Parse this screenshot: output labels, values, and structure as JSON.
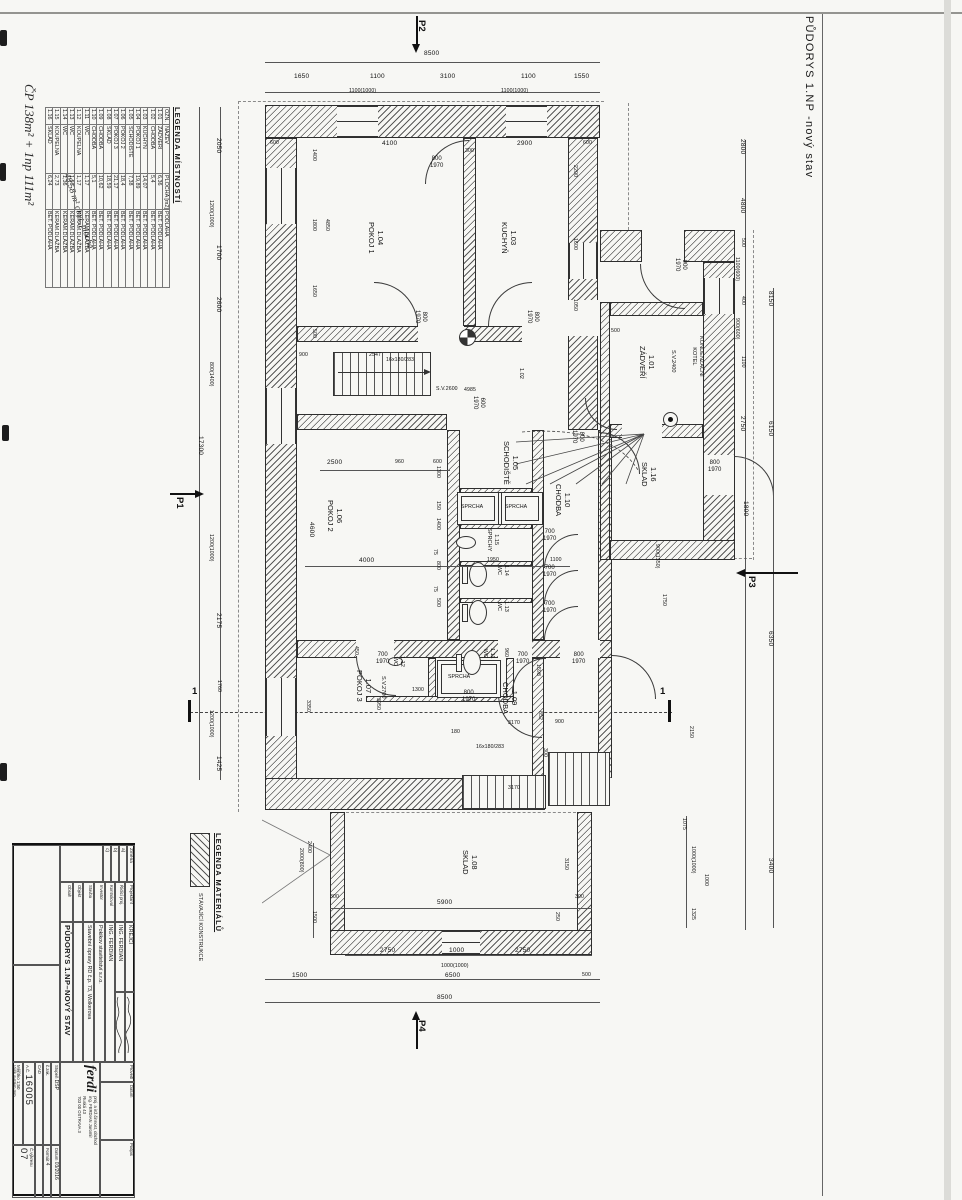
{
  "sheet": {
    "title": "PŮDORYS 1.NP  -nový stav",
    "handwriting_top": "ČP 138m² + 1np 111m²",
    "handwriting_table": "48,58 m² obyt. plocha"
  },
  "legend_rooms": {
    "title": "LEGENDA MÍSTNOSTÍ",
    "headers": [
      "OZN.",
      "NÁZEV",
      "PLOCHA [m2]",
      "PODLAHA"
    ],
    "rows": [
      [
        "1.01",
        "ZÁDVEŘÍ",
        "6,36",
        "BET. PODLAHA"
      ],
      [
        "1.02",
        "CHODBA",
        "5,4",
        "BET. PODLAHA"
      ],
      [
        "1.03",
        "KUCHYŇ",
        "14,07",
        "BET. PODLAHA"
      ],
      [
        "1.04",
        "POKOJ 1",
        "19,89",
        "BET. PODLAHA"
      ],
      [
        "1.05",
        "SCHODIŠTĚ",
        "7,38",
        "BET. PODLAHA"
      ],
      [
        "1.06",
        "POKOJ 2",
        "18,4",
        "BET. PODLAHA"
      ],
      [
        "1.07",
        "POKOJ 3",
        "21,17",
        "BET. PODLAHA"
      ],
      [
        "1.08",
        "SKLAD",
        "18,59",
        "BET. PODLAHA"
      ],
      [
        "1.09",
        "CHODBA",
        "10,62",
        "BET. PODLAHA"
      ],
      [
        "1.10",
        "CHODBA",
        "5,1",
        "BET. PODLAHA"
      ],
      [
        "1.11",
        "WC",
        "1,17",
        "KERAM.DLAŽBA"
      ],
      [
        "1.12",
        "KOUPELNA",
        "1,17",
        "KERAM.DLAŽBA"
      ],
      [
        "1.13",
        "WC",
        "1,56",
        "KERAM.DLAŽBA"
      ],
      [
        "1.14",
        "WC",
        "1,36",
        "KERAM.DLAŽBA"
      ],
      [
        "1.15",
        "KOUPELNA",
        "2,73",
        "KERAM.DLAŽBA"
      ],
      [
        "1.16",
        "SKLAD",
        "6,24",
        "BET. PODLAHA"
      ]
    ]
  },
  "legend_materials": {
    "title": "LEGENDA  MATERIÁLŮ",
    "item1": "STÁVAJÍCÍ KONSTRUKCE"
  },
  "titleblock": {
    "zmena_label": "Změna",
    "zmena_a": "a)",
    "zmena_b": "b)",
    "zmena_c": "c)",
    "projektant_label": "Projektant",
    "projektant_value": "KREJČÍ",
    "ridici_label": "Řídící proj.",
    "ridici_value": "ING. FERDIAN",
    "kontroloval_label": "Kontroloval",
    "kontroloval_value": "ING. FERDIAN",
    "investor_label": "Investor",
    "investor_value": "Pokikov stavitelství s.r.o.",
    "stavba_label": "Stavba",
    "stavba_value": "Stavební úpravy RD č.p. 73, Wolkerova",
    "objekt_label": "Objekt",
    "obsah_label": "Obsah",
    "obsah_value": "PŮDORYS 1.NP–NOVÝ STAV",
    "provedl_label": "Provedl",
    "datum_label": "Datum",
    "podpis_label": "Podpis",
    "firm_logo": "ferdi",
    "firm_line1": "proj. a inž.činnost, obchod",
    "firm_line2": "ing. FERDIAN Jaromír",
    "firm_line3": "Ruská 43",
    "firm_line4": "703 00 OSTRAVA 3",
    "stupen_label": "Stupeň",
    "stupen_value": "DSP",
    "datum2_label": "Datum",
    "datum2_value": "03/2016",
    "zakazka_label": "č.zak.",
    "format_label": "Formát",
    "format_value": "4",
    "cad_label": "CAD",
    "ac_label": "A.Č.",
    "ac_value": "16005",
    "meritko_label": "Měřítko",
    "meritko_value": "1:50",
    "vysky_label": "Výšk.systém",
    "vysky_value": "mm",
    "cvykresu_label": "Č.výkresu",
    "cvykresu_value": "07"
  },
  "plan": {
    "labels": [
      {
        "t": "1.04\nPOKOJ 1",
        "x": 370,
        "y": 222,
        "r": 1,
        "c": "room",
        "n": "room-label-1-04"
      },
      {
        "t": "1.03\nKUCHYŇ",
        "x": 503,
        "y": 222,
        "r": 1,
        "c": "room",
        "n": "room-label-1-03"
      },
      {
        "t": "1.01\nZÁDVEŘÍ",
        "x": 641,
        "y": 346,
        "r": 1,
        "c": "room",
        "n": "room-label-1-01"
      },
      {
        "t": "1.05\nSCHODIŠTĚ",
        "x": 505,
        "y": 441,
        "r": 1,
        "c": "room",
        "n": "room-label-1-05"
      },
      {
        "t": "1.10\nCHODBA",
        "x": 557,
        "y": 484,
        "r": 1,
        "c": "room",
        "n": "room-label-1-10"
      },
      {
        "t": "1.06\nPOKOJ 2",
        "x": 329,
        "y": 500,
        "r": 1,
        "c": "room",
        "n": "room-label-1-06"
      },
      {
        "t": "1.16\nSKLAD",
        "x": 643,
        "y": 462,
        "r": 1,
        "c": "room",
        "n": "room-label-1-16"
      },
      {
        "t": "1.07\nPOKOJ 3",
        "x": 358,
        "y": 670,
        "r": 1,
        "c": "room",
        "n": "room-label-1-07"
      },
      {
        "t": "1.09\nCHODBA",
        "x": 504,
        "y": 682,
        "r": 1,
        "c": "room",
        "n": "room-label-1-09"
      },
      {
        "t": "1.08\nSKLAD",
        "x": 464,
        "y": 850,
        "r": 1,
        "c": "room",
        "n": "room-label-1-08"
      },
      {
        "t": "1.15\nSPRCHY",
        "x": 484,
        "y": 528,
        "r": 1,
        "c": "roomt",
        "n": "room-label-1-15"
      },
      {
        "t": "1.14\nWC",
        "x": 494,
        "y": 565,
        "r": 1,
        "c": "roomt",
        "n": "room-label-1-14"
      },
      {
        "t": "1.13\nWC",
        "x": 494,
        "y": 601,
        "r": 1,
        "c": "roomt",
        "n": "room-label-1-13"
      },
      {
        "t": "1.12\nWC",
        "x": 390,
        "y": 656,
        "r": 1,
        "c": "roomt",
        "n": "room-label-1-12"
      },
      {
        "t": "1.11\nWC",
        "x": 480,
        "y": 648,
        "r": 1,
        "c": "roomt",
        "n": "room-label-1-11"
      },
      {
        "t": "1.02",
        "x": 516,
        "y": 368,
        "r": 1,
        "c": "roomt",
        "n": "room-label-1-02"
      },
      {
        "t": "S.V.2400",
        "x": 668,
        "y": 350,
        "r": 1,
        "c": "roomt",
        "n": "ceiling-height-label"
      },
      {
        "t": "S.V.2700",
        "x": 378,
        "y": 676,
        "r": 1,
        "c": "roomt",
        "n": "ceiling-height-label"
      },
      {
        "t": "S.V.2600",
        "x": 436,
        "y": 386,
        "r": 0,
        "c": "t",
        "n": "ceiling-height-label"
      },
      {
        "t": "KONDENZAČNÍ\nKOTEL",
        "x": 689,
        "y": 336,
        "r": 1,
        "c": "roomt",
        "n": "boiler-label"
      },
      {
        "t": "SPRCHA",
        "x": 461,
        "y": 504,
        "r": 0,
        "c": "t",
        "n": "shower-label"
      },
      {
        "t": "SPRCHA",
        "x": 505,
        "y": 504,
        "r": 0,
        "c": "t",
        "n": "shower-label"
      },
      {
        "t": "SPRCHA",
        "x": 448,
        "y": 674,
        "r": 0,
        "c": "t",
        "n": "shower-label"
      },
      {
        "t": "16x180/283",
        "x": 386,
        "y": 357,
        "r": 0,
        "c": "t",
        "n": "stair-label"
      },
      {
        "t": "16x180/283",
        "x": 476,
        "y": 744,
        "r": 0,
        "c": "t",
        "n": "stair-label"
      },
      {
        "t": "800\n1970",
        "x": 430,
        "y": 156,
        "r": 0,
        "c": "door",
        "n": "door-size-label"
      },
      {
        "t": "800\n1970",
        "x": 412,
        "y": 310,
        "r": 1,
        "c": "door",
        "n": "door-size-label"
      },
      {
        "t": "800\n1970",
        "x": 524,
        "y": 310,
        "r": 1,
        "c": "door",
        "n": "door-size-label"
      },
      {
        "t": "900\n1970",
        "x": 672,
        "y": 258,
        "r": 1,
        "c": "door",
        "n": "door-size-label"
      },
      {
        "t": "800\n1970",
        "x": 569,
        "y": 430,
        "r": 1,
        "c": "door",
        "n": "door-size-label"
      },
      {
        "t": "600\n1970",
        "x": 470,
        "y": 396,
        "r": 1,
        "c": "door",
        "n": "door-size-label"
      },
      {
        "t": "700\n1970",
        "x": 543,
        "y": 529,
        "r": 0,
        "c": "door",
        "n": "door-size-label"
      },
      {
        "t": "700\n1970",
        "x": 543,
        "y": 565,
        "r": 0,
        "c": "door",
        "n": "door-size-label"
      },
      {
        "t": "700\n1970",
        "x": 543,
        "y": 601,
        "r": 0,
        "c": "door",
        "n": "door-size-label"
      },
      {
        "t": "700\n1970",
        "x": 376,
        "y": 652,
        "r": 0,
        "c": "door",
        "n": "door-size-label"
      },
      {
        "t": "700\n1970",
        "x": 516,
        "y": 652,
        "r": 0,
        "c": "door",
        "n": "door-size-label"
      },
      {
        "t": "800\n1970",
        "x": 572,
        "y": 652,
        "r": 0,
        "c": "door",
        "n": "door-size-label"
      },
      {
        "t": "800\n1970",
        "x": 462,
        "y": 690,
        "r": 0,
        "c": "door",
        "n": "door-size-label"
      },
      {
        "t": "800\n1970",
        "x": 708,
        "y": 460,
        "r": 0,
        "c": "door",
        "n": "door-size-label"
      },
      {
        "t": "8500",
        "x": 424,
        "y": 50
      },
      {
        "t": "1650",
        "x": 294,
        "y": 73
      },
      {
        "t": "1100",
        "x": 370,
        "y": 73
      },
      {
        "t": "3100",
        "x": 440,
        "y": 73
      },
      {
        "t": "1100",
        "x": 521,
        "y": 73
      },
      {
        "t": "1550",
        "x": 574,
        "y": 73
      },
      {
        "t": "1100(1000)",
        "x": 349,
        "y": 88,
        "c": "t"
      },
      {
        "t": "1100(1000)",
        "x": 501,
        "y": 88,
        "c": "t"
      },
      {
        "t": "600",
        "x": 270,
        "y": 140,
        "c": "t"
      },
      {
        "t": "4100",
        "x": 382,
        "y": 140
      },
      {
        "t": "300",
        "x": 465,
        "y": 148,
        "c": "t"
      },
      {
        "t": "2900",
        "x": 517,
        "y": 140
      },
      {
        "t": "600",
        "x": 583,
        "y": 140,
        "c": "t"
      },
      {
        "t": "900",
        "x": 299,
        "y": 352,
        "c": "t"
      },
      {
        "t": "2547",
        "x": 369,
        "y": 352,
        "c": "t"
      },
      {
        "t": "4985",
        "x": 464,
        "y": 387,
        "c": "t"
      },
      {
        "t": "500",
        "x": 611,
        "y": 328,
        "c": "t"
      },
      {
        "t": "2500",
        "x": 327,
        "y": 459
      },
      {
        "t": "960",
        "x": 395,
        "y": 459,
        "c": "t"
      },
      {
        "t": "600",
        "x": 433,
        "y": 459,
        "c": "t"
      },
      {
        "t": "4000",
        "x": 359,
        "y": 557
      },
      {
        "t": "1950",
        "x": 487,
        "y": 557,
        "c": "t"
      },
      {
        "t": "1100",
        "x": 550,
        "y": 557,
        "c": "t"
      },
      {
        "t": "1300",
        "x": 412,
        "y": 687,
        "c": "t"
      },
      {
        "t": "180",
        "x": 451,
        "y": 729,
        "c": "t"
      },
      {
        "t": "3170",
        "x": 508,
        "y": 720,
        "c": "t"
      },
      {
        "t": "900",
        "x": 555,
        "y": 719,
        "c": "t"
      },
      {
        "t": "3170",
        "x": 508,
        "y": 785,
        "c": "t"
      },
      {
        "t": "5900",
        "x": 437,
        "y": 899
      },
      {
        "t": "300",
        "x": 330,
        "y": 894,
        "c": "t"
      },
      {
        "t": "300",
        "x": 575,
        "y": 894,
        "c": "t"
      },
      {
        "t": "2750",
        "x": 380,
        "y": 947
      },
      {
        "t": "1000",
        "x": 449,
        "y": 947
      },
      {
        "t": "2750",
        "x": 515,
        "y": 947
      },
      {
        "t": "1000(1000)",
        "x": 441,
        "y": 963,
        "c": "t"
      },
      {
        "t": "1500",
        "x": 292,
        "y": 972
      },
      {
        "t": "6500",
        "x": 445,
        "y": 972
      },
      {
        "t": "500",
        "x": 582,
        "y": 972,
        "c": "t"
      },
      {
        "t": "8500",
        "x": 437,
        "y": 994
      },
      {
        "t": "2050",
        "x": 214,
        "y": 138,
        "r": 1
      },
      {
        "t": "1200(1000)",
        "x": 206,
        "y": 200,
        "r": 1,
        "c": "t"
      },
      {
        "t": "1700",
        "x": 214,
        "y": 245,
        "r": 1
      },
      {
        "t": "2600",
        "x": 214,
        "y": 297,
        "r": 1
      },
      {
        "t": "800(1400)",
        "x": 206,
        "y": 362,
        "r": 1,
        "c": "t"
      },
      {
        "t": "1200(1000)",
        "x": 206,
        "y": 534,
        "r": 1,
        "c": "t"
      },
      {
        "t": "2175",
        "x": 214,
        "y": 613,
        "r": 1
      },
      {
        "t": "1760",
        "x": 214,
        "y": 680,
        "r": 1,
        "c": "t"
      },
      {
        "t": "1200(1000)",
        "x": 206,
        "y": 710,
        "r": 1,
        "c": "t"
      },
      {
        "t": "1425",
        "x": 214,
        "y": 756,
        "r": 1
      },
      {
        "t": "17300",
        "x": 196,
        "y": 436,
        "r": 1
      },
      {
        "t": "1400",
        "x": 309,
        "y": 149,
        "r": 1,
        "c": "t"
      },
      {
        "t": "1800",
        "x": 309,
        "y": 219,
        "r": 1,
        "c": "t"
      },
      {
        "t": "1650",
        "x": 309,
        "y": 285,
        "r": 1,
        "c": "t"
      },
      {
        "t": "4850",
        "x": 322,
        "y": 219,
        "r": 1,
        "c": "t"
      },
      {
        "t": "500",
        "x": 309,
        "y": 329,
        "r": 1,
        "c": "t"
      },
      {
        "t": "4600",
        "x": 307,
        "y": 522,
        "r": 1
      },
      {
        "t": "3350",
        "x": 303,
        "y": 700,
        "r": 1,
        "c": "t"
      },
      {
        "t": "3950",
        "x": 373,
        "y": 698,
        "r": 1,
        "c": "t"
      },
      {
        "t": "450",
        "x": 351,
        "y": 646,
        "r": 1,
        "c": "t"
      },
      {
        "t": "2200",
        "x": 570,
        "y": 165,
        "r": 1,
        "c": "t"
      },
      {
        "t": "1600",
        "x": 570,
        "y": 238,
        "r": 1,
        "c": "t"
      },
      {
        "t": "1050",
        "x": 570,
        "y": 299,
        "r": 1,
        "c": "t"
      },
      {
        "t": "1300",
        "x": 433,
        "y": 466,
        "r": 1,
        "c": "t"
      },
      {
        "t": "150",
        "x": 433,
        "y": 501,
        "r": 1,
        "c": "t"
      },
      {
        "t": "1400",
        "x": 433,
        "y": 518,
        "r": 1,
        "c": "t"
      },
      {
        "t": "75",
        "x": 430,
        "y": 549,
        "r": 1,
        "c": "t"
      },
      {
        "t": "800",
        "x": 433,
        "y": 561,
        "r": 1,
        "c": "t"
      },
      {
        "t": "75",
        "x": 430,
        "y": 586,
        "r": 1,
        "c": "t"
      },
      {
        "t": "500",
        "x": 433,
        "y": 598,
        "r": 1,
        "c": "t"
      },
      {
        "t": "960",
        "x": 501,
        "y": 648,
        "r": 1,
        "c": "t"
      },
      {
        "t": "1598",
        "x": 533,
        "y": 664,
        "r": 1,
        "c": "t"
      },
      {
        "t": "852",
        "x": 535,
        "y": 711,
        "r": 1,
        "c": "t"
      },
      {
        "t": "300",
        "x": 540,
        "y": 748,
        "r": 1,
        "c": "t"
      },
      {
        "t": "900(1350)",
        "x": 652,
        "y": 544,
        "r": 1,
        "c": "t"
      },
      {
        "t": "1750",
        "x": 659,
        "y": 594,
        "r": 1,
        "c": "t"
      },
      {
        "t": "1800",
        "x": 741,
        "y": 501,
        "r": 1
      },
      {
        "t": "2150",
        "x": 686,
        "y": 726,
        "r": 1,
        "c": "t"
      },
      {
        "t": "2800",
        "x": 738,
        "y": 139,
        "r": 1
      },
      {
        "t": "4800",
        "x": 738,
        "y": 198,
        "r": 1
      },
      {
        "t": "500",
        "x": 738,
        "y": 238,
        "r": 1,
        "c": "t"
      },
      {
        "t": "1100(600)",
        "x": 732,
        "y": 257,
        "r": 1,
        "c": "t"
      },
      {
        "t": "400",
        "x": 738,
        "y": 296,
        "r": 1,
        "c": "t"
      },
      {
        "t": "900(600)",
        "x": 732,
        "y": 318,
        "r": 1,
        "c": "t"
      },
      {
        "t": "1100",
        "x": 738,
        "y": 356,
        "r": 1,
        "c": "t"
      },
      {
        "t": "2750",
        "x": 738,
        "y": 416,
        "r": 1
      },
      {
        "t": "8150",
        "x": 766,
        "y": 291,
        "r": 1
      },
      {
        "t": "6150",
        "x": 766,
        "y": 421,
        "r": 1
      },
      {
        "t": "6350",
        "x": 766,
        "y": 631,
        "r": 1
      },
      {
        "t": "3400",
        "x": 766,
        "y": 858,
        "r": 1
      },
      {
        "t": "3150",
        "x": 561,
        "y": 858,
        "r": 1,
        "c": "t"
      },
      {
        "t": "250",
        "x": 552,
        "y": 912,
        "r": 1,
        "c": "t"
      },
      {
        "t": "2400",
        "x": 304,
        "y": 841,
        "r": 1,
        "c": "t"
      },
      {
        "t": "2000(800)",
        "x": 296,
        "y": 848,
        "r": 1,
        "c": "t"
      },
      {
        "t": "1500",
        "x": 309,
        "y": 911,
        "r": 1,
        "c": "t"
      },
      {
        "t": "1075",
        "x": 679,
        "y": 818,
        "r": 1,
        "c": "t"
      },
      {
        "t": "1000(1000)",
        "x": 688,
        "y": 846,
        "r": 1,
        "c": "t"
      },
      {
        "t": "1000",
        "x": 701,
        "y": 874,
        "r": 1,
        "c": "t"
      },
      {
        "t": "1325",
        "x": 688,
        "y": 908,
        "r": 1,
        "c": "t"
      },
      {
        "t": "P1",
        "x": 177,
        "y": 497,
        "r": 1,
        "c": "sec",
        "n": "section-mark-p1"
      },
      {
        "t": "P2",
        "x": 419,
        "y": 20,
        "r": 1,
        "c": "sec",
        "n": "section-mark-p2"
      },
      {
        "t": "P3",
        "x": 749,
        "y": 576,
        "r": 1,
        "c": "sec",
        "n": "section-mark-p3"
      },
      {
        "t": "P4",
        "x": 419,
        "y": 1020,
        "r": 1,
        "c": "sec",
        "n": "section-mark-p4"
      },
      {
        "t": "1",
        "x": 192,
        "y": 686,
        "r": 0,
        "c": "sec",
        "n": "section-mark-1"
      },
      {
        "t": "1",
        "x": 660,
        "y": 686,
        "r": 0,
        "c": "sec",
        "n": "section-mark-1"
      }
    ]
  }
}
